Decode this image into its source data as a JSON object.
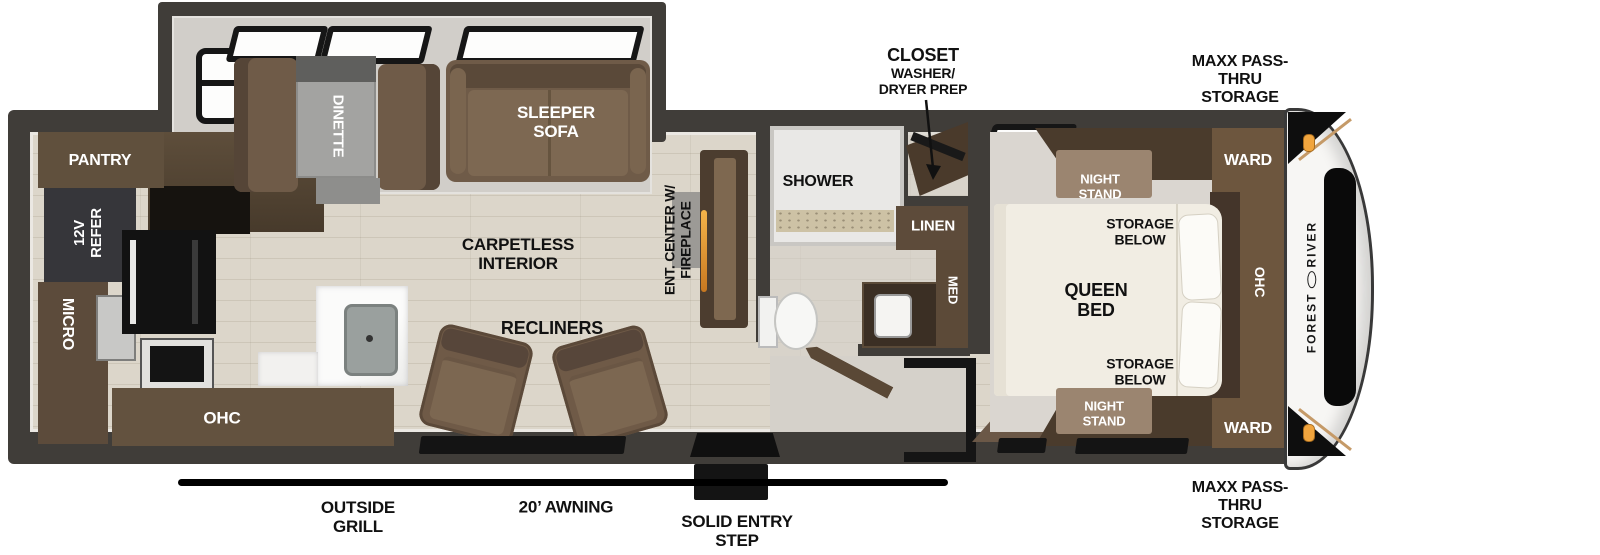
{
  "floorplan": {
    "brand": {
      "word1": "FOREST",
      "word2": "RIVER"
    },
    "exterior": {
      "storage_top": "MAXX PASS-THRU STORAGE",
      "storage_bottom": "MAXX PASS-THRU STORAGE",
      "awning": "20’ AWNING",
      "grill": "OUTSIDE GRILL",
      "step": "SOLID ENTRY STEP"
    },
    "kitchen": {
      "pantry": "PANTRY",
      "refer": "12V REFER",
      "micro": "MICRO",
      "ohc": "OHC"
    },
    "living": {
      "dinette": "DINETTE",
      "sofa": "SLEEPER SOFA",
      "floor_note": "CARPETLESS INTERIOR",
      "recliners": "RECLINERS",
      "ent_center": "ENT. CENTER W/ FIREPLACE"
    },
    "bath": {
      "shower": "SHOWER",
      "linen": "LINEN",
      "med": "MED",
      "closet": "CLOSET",
      "closet_sub1": "WASHER/",
      "closet_sub2": "DRYER PREP"
    },
    "bedroom": {
      "bed": "QUEEN BED",
      "storage_top": "STORAGE BELOW",
      "storage_bottom": "STORAGE BELOW",
      "nightstand_top": "NIGHT STAND",
      "nightstand_bottom": "NIGHT STAND",
      "ward_top": "WARD",
      "ward_bottom": "WARD",
      "ohc": "OHC"
    }
  },
  "colors": {
    "wall": "#403d39",
    "wood_floor": "#dcd6ca",
    "slide_floor": "#d1cec9",
    "cabinet_dark": "#4a3b2c",
    "cabinet": "#6f5b48",
    "nightstand": "#9b8570",
    "bed": "#f1ede3",
    "marker_light": "#f1a53e",
    "annotation": "#111111",
    "glass": "#fdfdfc"
  }
}
